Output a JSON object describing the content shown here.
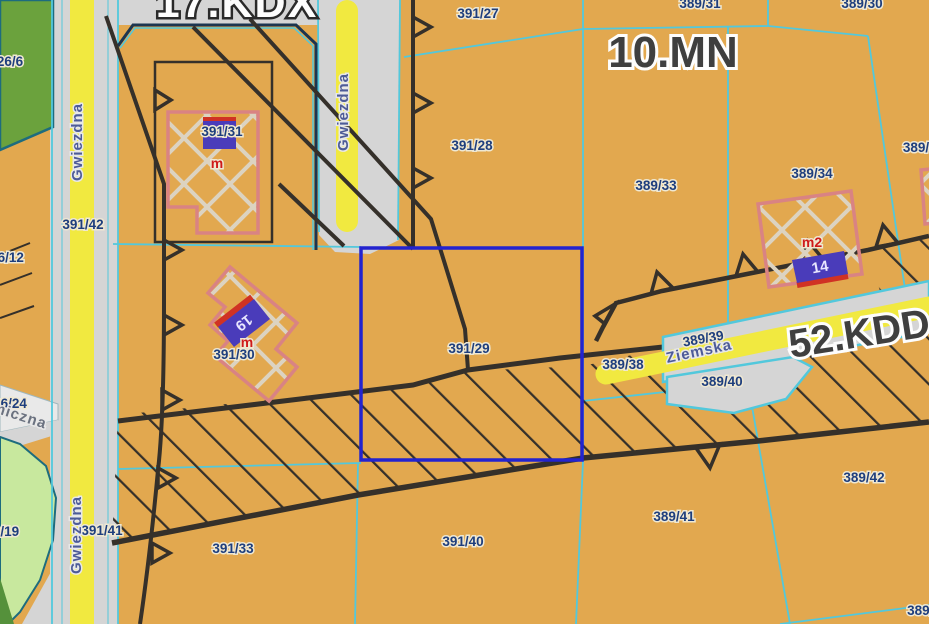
{
  "zones": {
    "kdx": "17.KDX",
    "mn": "10.MN",
    "kd": "52.KDD"
  },
  "streets": {
    "gwiezdna": "Gwiezdna",
    "ziemska": "Ziemska",
    "miczna_partial": "miczna"
  },
  "parcels": [
    "391/27",
    "389/31",
    "389/30",
    "391/28",
    "389/33",
    "389/34",
    "389/",
    "391/42",
    "26/6",
    "26/12",
    "391/31",
    "391/30",
    "391/29",
    "389/38",
    "389/39",
    "389/40",
    "389/41",
    "389/42",
    "389/5",
    "391/33",
    "391/40",
    "391/41",
    "26/24",
    "6/19"
  ],
  "building_labels": {
    "m1": "m",
    "m2": "m",
    "m3": "m2"
  },
  "markers": {
    "m19": "19",
    "m14": "14"
  },
  "selection": {
    "parcel": "391/29"
  },
  "colors": {
    "background_zone_mn": "#e2a84f",
    "road_gray": "#d5d5d5",
    "road_yellow": "#f1e940",
    "parcel_line_cyan": "#52c8dc",
    "boundary_black": "#35302a",
    "selection_blue": "#2323cf",
    "building_pink": "#d98383",
    "marker_purple": "#4a3cba",
    "marker_red": "#d03224",
    "green_dark": "#6ba23d",
    "green_light": "#c8e89e",
    "label_navy": "#1e3e7d"
  }
}
